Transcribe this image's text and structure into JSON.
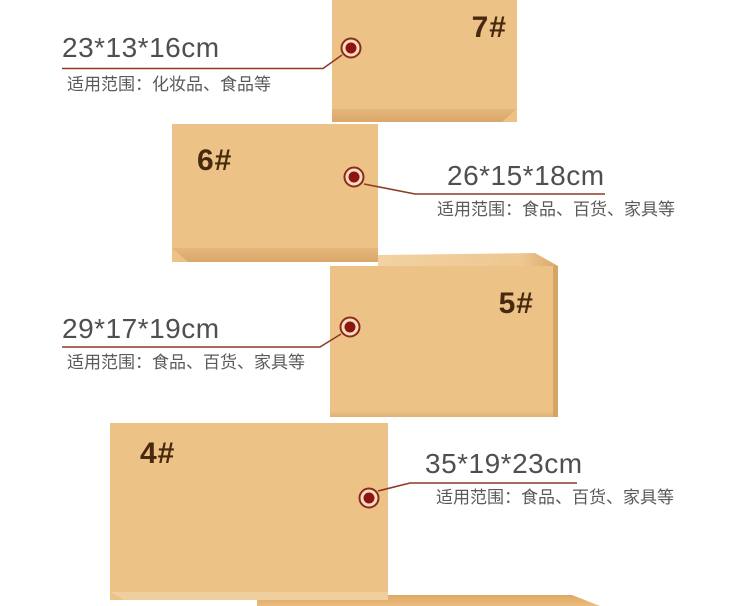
{
  "colors": {
    "box-face": "#ecc287",
    "box-num": "#46290e",
    "dim-text": "#4f4f4f",
    "scope-text": "#5a5a5a",
    "line": "#8e3a24",
    "ring-stroke": "#8c2c17",
    "ring-fill": "#f6ddc3",
    "dot": "#8d150d"
  },
  "boxes": [
    {
      "label": "7#"
    },
    {
      "label": "6#"
    },
    {
      "label": "5#"
    },
    {
      "label": "4#"
    }
  ],
  "callouts": [
    {
      "dimensions": "23*13*16cm",
      "scope": "适用范围：化妆品、食品等"
    },
    {
      "dimensions": "26*15*18cm",
      "scope": "适用范围：食品、百货、家具等"
    },
    {
      "dimensions": "29*17*19cm",
      "scope": "适用范围：食品、百货、家具等"
    },
    {
      "dimensions": "35*19*23cm",
      "scope": "适用范围：食品、百货、家具等"
    }
  ]
}
